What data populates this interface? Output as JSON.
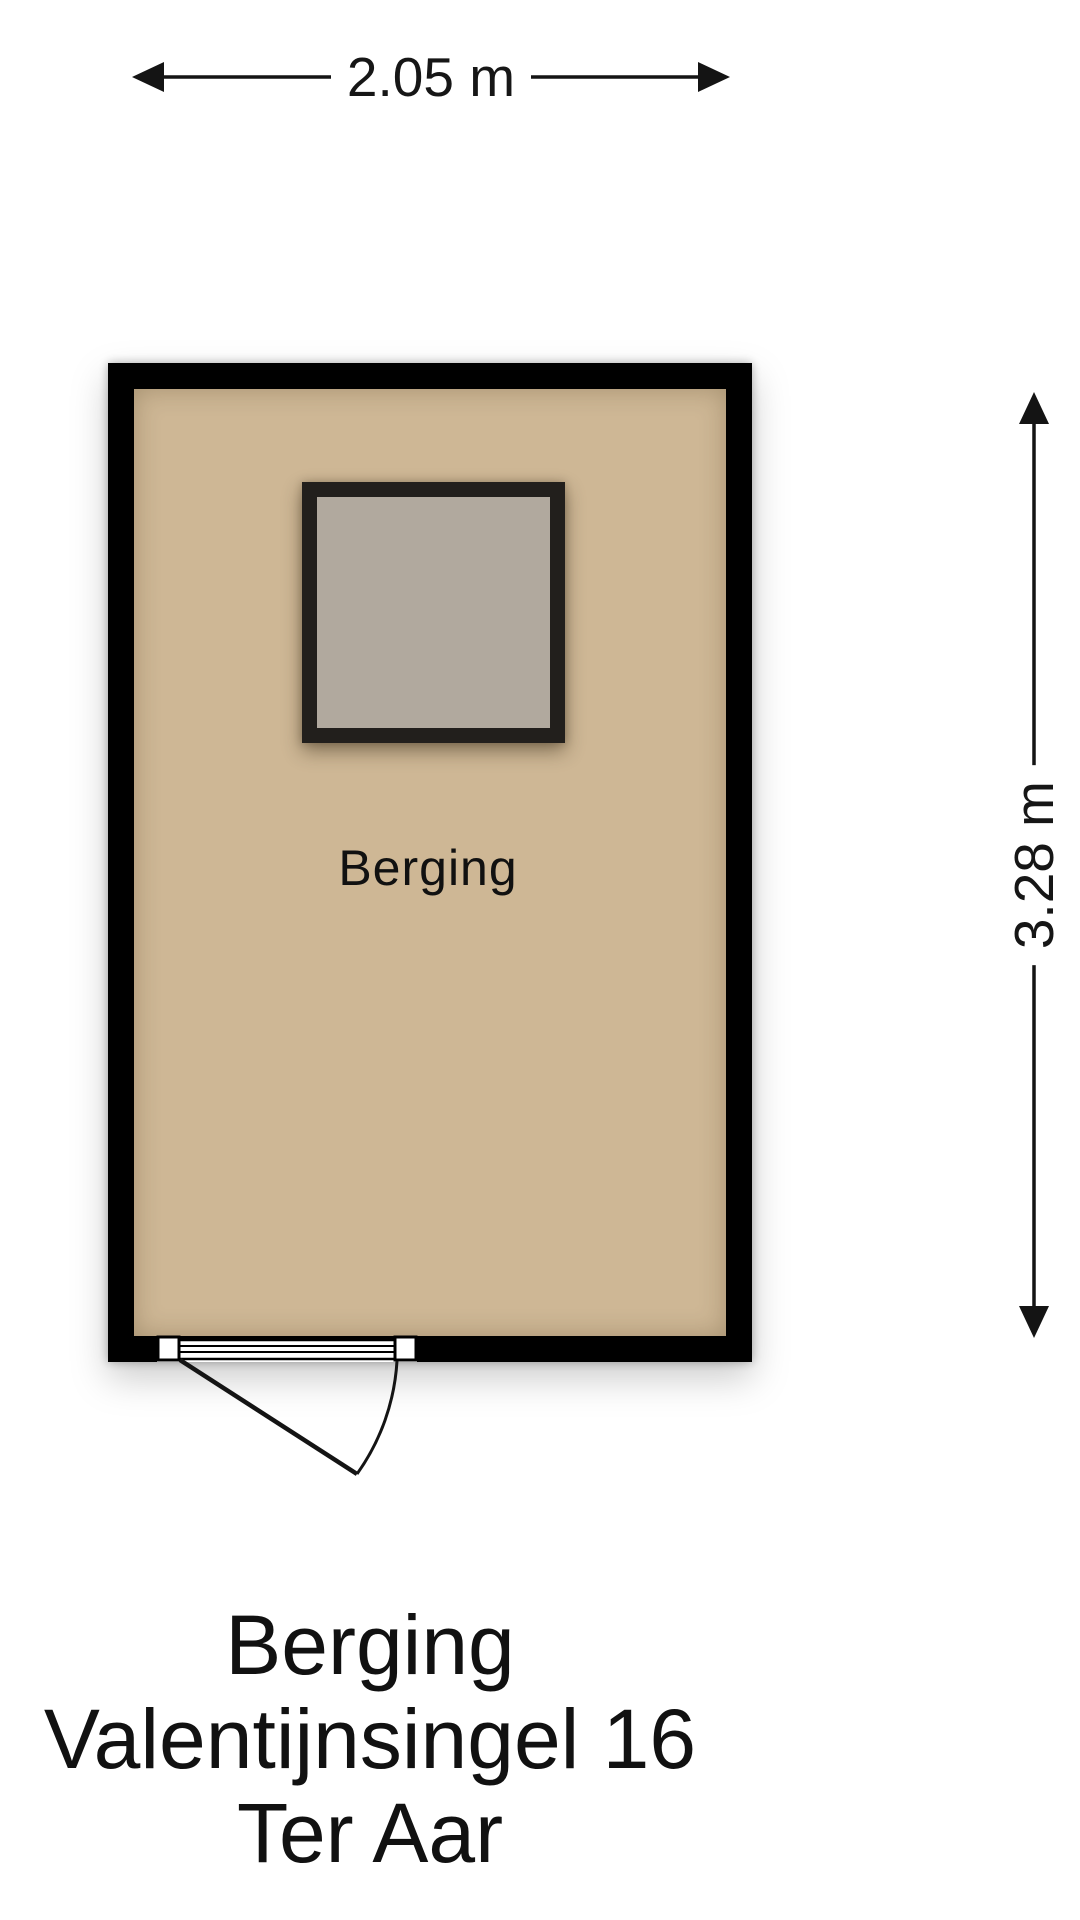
{
  "dimensions": {
    "width": {
      "label": "2.05 m"
    },
    "height": {
      "label": "3.28 m"
    }
  },
  "room": {
    "label": "Berging"
  },
  "caption": {
    "lines": [
      "Berging",
      "Valentijnsingel 16",
      "Ter Aar"
    ]
  },
  "icons": {
    "width_dimension": [
      "arrow-left-icon",
      "arrow-right-icon"
    ],
    "height_dimension": [
      "arrow-up-icon",
      "arrow-down-icon"
    ]
  },
  "colors": {
    "background": "#ffffff",
    "wall": "#000000",
    "floor": "#ceb795",
    "skylight_fill": "#b1a99e",
    "skylight_frame": "#221f1c",
    "line": "#141414",
    "text": "#111111"
  }
}
